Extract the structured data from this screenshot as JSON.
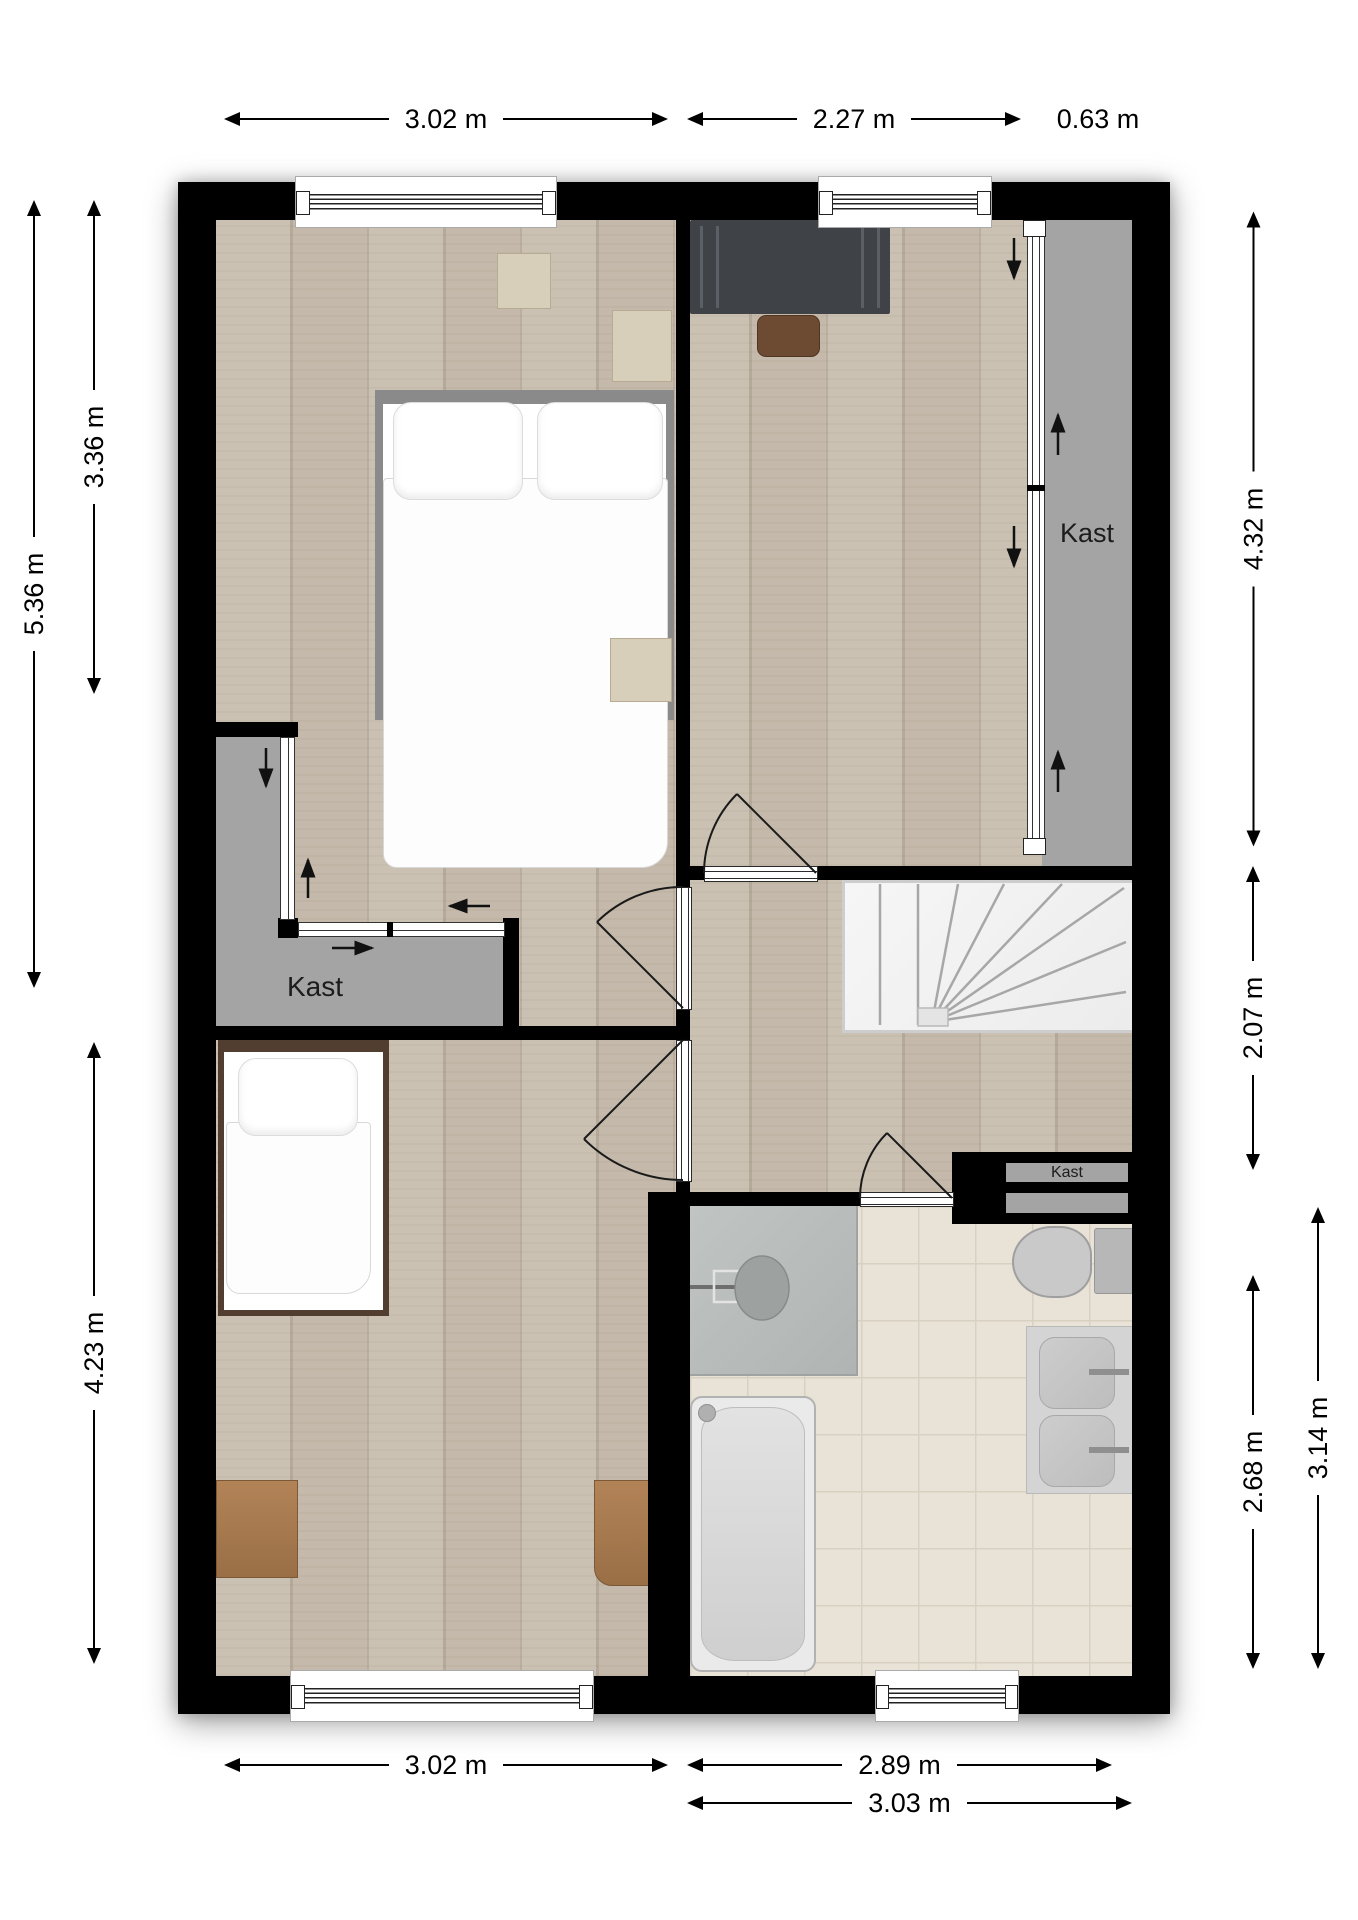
{
  "plan": {
    "closet_left_label": "Kast",
    "closet_right_label": "Kast",
    "closet_small_label": "Kast"
  },
  "dimensions": {
    "top_left": "3.02 m",
    "top_middle": "2.27 m",
    "top_right": "0.63 m",
    "left_full": "5.36 m",
    "left_upper": "3.36 m",
    "left_lower": "4.23 m",
    "right_upper": "4.32 m",
    "right_middle": "2.07 m",
    "right_lower_inner": "2.68 m",
    "right_lower_outer": "3.14 m",
    "bottom_left": "3.02 m",
    "bottom_middle": "2.89 m",
    "bottom_right": "3.03 m"
  },
  "colors": {
    "wall": "#000000",
    "wood_floor": "#c8bdae",
    "closet_floor": "#a4a4a4",
    "bathroom_tile": "#e9e2d6",
    "shower_floor": "#b8bcba",
    "furniture_wood": "#a87a50"
  }
}
